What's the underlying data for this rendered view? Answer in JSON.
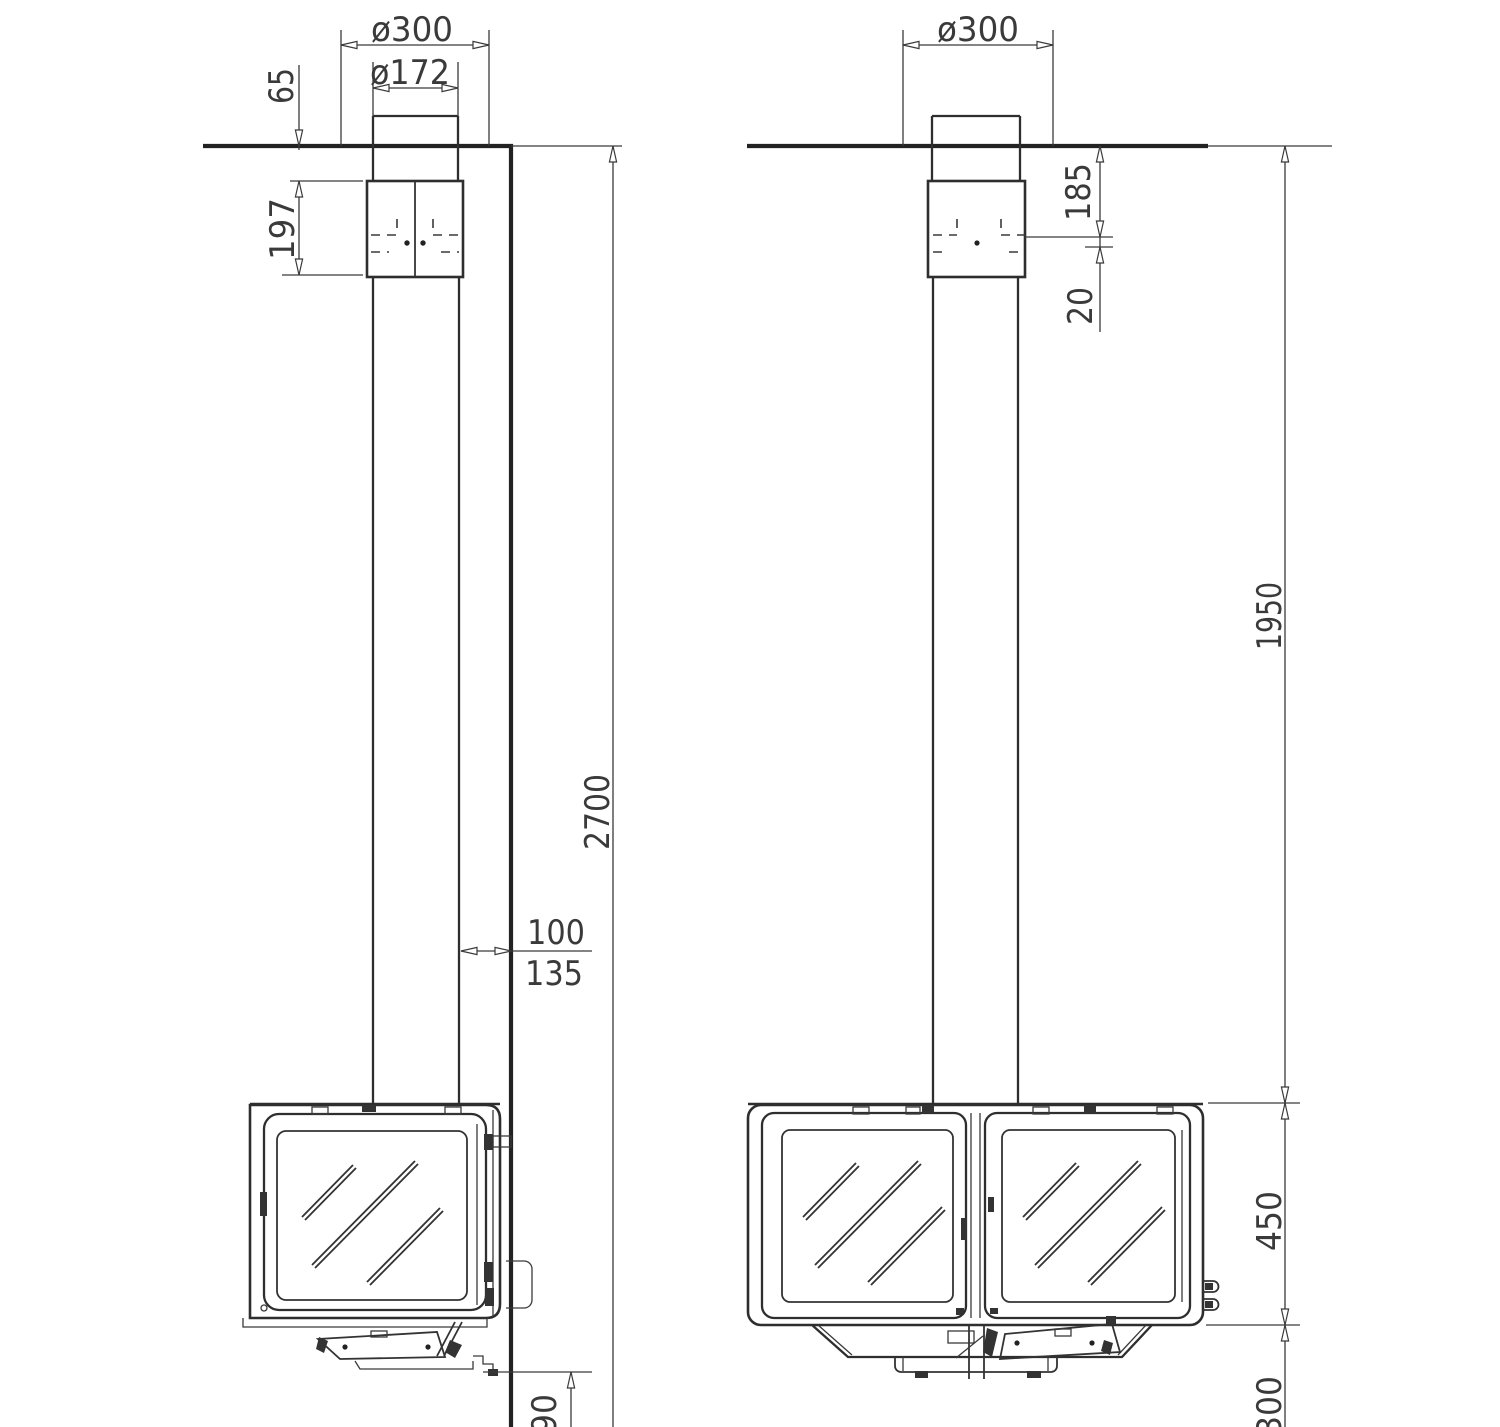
{
  "drawing": {
    "kind": "technical installation drawing, suspended wood stove, two views",
    "line_color": "#2e2e2e",
    "background": "#ffffff",
    "dims": {
      "left": {
        "flue_hole": "ø300",
        "flue_pipe": "ø172",
        "collar_above_ceiling": "65",
        "connector_height": "197",
        "ceiling_height": "2700",
        "pipe_wall_gap": "100",
        "body_wall_gap": "135",
        "base_height": "90"
      },
      "right": {
        "flue_hole": "ø300",
        "ceiling_to_outlet": "185",
        "outlet_step": "20",
        "ceiling_to_body": "1950",
        "body_height": "450",
        "below_body": "300"
      }
    }
  }
}
